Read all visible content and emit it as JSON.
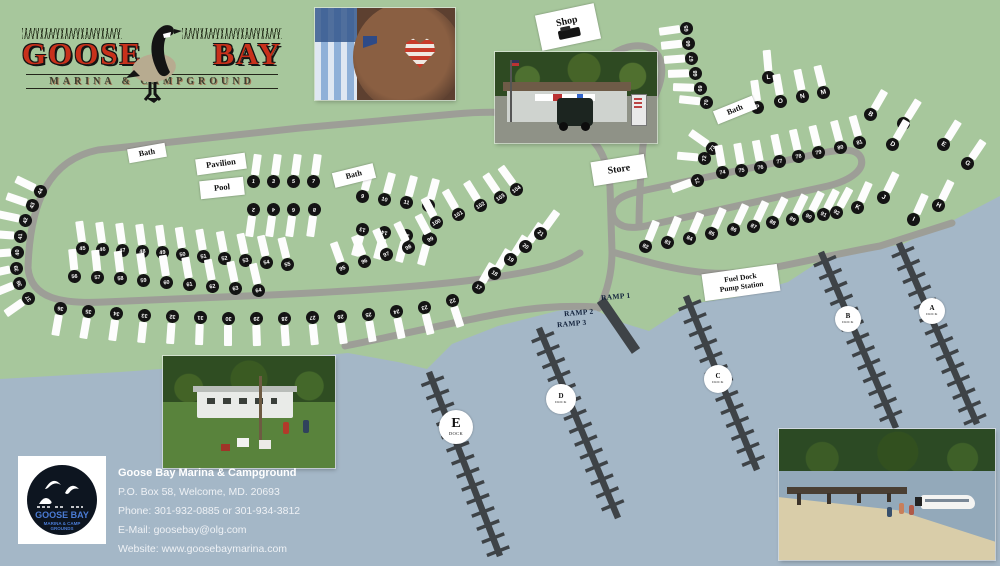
{
  "logo": {
    "word1": "GOOSE",
    "word2": "BAY",
    "subtitle": "MARINA & CAMPGROUND"
  },
  "badge": {
    "line1": "GOOSE BAY",
    "line2": "MARINA & CAMP",
    "line3": "GROUNDS"
  },
  "contact": {
    "title": "Goose Bay Marina & Campground",
    "address": "P.O. Box 58, Welcome, MD. 20693",
    "phone": "Phone: 301-932-0885 or 301-934-3812",
    "email": "E-Mail: goosebay@olg.com",
    "website": "Website: www.goosebaymarina.com"
  },
  "colors": {
    "land": "#a7c79c",
    "water": "#a4b7c7",
    "road": "#9d9e97",
    "dock": "#3e4347",
    "site_circle": "#141414",
    "logo_red": "#c8311b"
  },
  "photos": {
    "top_center": "kid-with-flag-heart-sunglasses-photo",
    "store": "marina-store-photo",
    "bottom_left": "campground-trailer-photo",
    "bottom_right": "beach-and-boat-photo"
  },
  "map": {
    "dock_word": "DOCK",
    "labels": [
      {
        "name": "bath-label-1",
        "lines": [
          "Bath"
        ],
        "x": 128,
        "y": 146,
        "w": 38,
        "h": 14,
        "rot": -10,
        "fs": 8
      },
      {
        "name": "pavilion-label",
        "lines": [
          "Pavilion"
        ],
        "x": 196,
        "y": 156,
        "w": 50,
        "h": 16,
        "rot": -8,
        "fs": 8.5
      },
      {
        "name": "pool-label",
        "lines": [
          "Pool"
        ],
        "x": 200,
        "y": 179,
        "w": 44,
        "h": 18,
        "rot": -6,
        "fs": 8.5
      },
      {
        "name": "bath-label-2",
        "lines": [
          "Bath"
        ],
        "x": 333,
        "y": 168,
        "w": 42,
        "h": 15,
        "rot": -14,
        "fs": 8
      },
      {
        "name": "store-label",
        "lines": [
          "Store"
        ],
        "x": 592,
        "y": 158,
        "w": 54,
        "h": 24,
        "rot": -9,
        "fs": 10
      },
      {
        "name": "shop-label",
        "lines": [
          "Shop"
        ],
        "x": 538,
        "y": 9,
        "w": 60,
        "h": 36,
        "rot": -12,
        "fs": 10,
        "icon": "mower"
      },
      {
        "name": "bath-label-3",
        "lines": [
          "Bath"
        ],
        "x": 714,
        "y": 103,
        "w": 42,
        "h": 14,
        "rot": -22,
        "fs": 8
      },
      {
        "name": "fuel-dock-label",
        "lines": [
          "Fuel Dock",
          "Pump Station"
        ],
        "x": 703,
        "y": 269,
        "w": 76,
        "h": 27,
        "rot": -8,
        "fs": 7.5
      },
      {
        "name": "ramp-1-label",
        "lines": [
          "RAMP 1"
        ],
        "x": 601,
        "y": 293,
        "rot": -5,
        "fs": 7.5,
        "box": false
      },
      {
        "name": "ramp-2-label",
        "lines": [
          "RAMP 2"
        ],
        "x": 564,
        "y": 309,
        "rot": -5,
        "fs": 7.5,
        "box": false
      },
      {
        "name": "ramp-3-label",
        "lines": [
          "RAMP 3"
        ],
        "x": 557,
        "y": 320,
        "rot": -5,
        "fs": 7.5,
        "box": false
      }
    ],
    "docks": [
      {
        "label": "A",
        "x1": 899,
        "y1": 243,
        "x2": 977,
        "y2": 424,
        "cx": 932,
        "cy": 311,
        "r": 13
      },
      {
        "label": "B",
        "x1": 821,
        "y1": 252,
        "x2": 896,
        "y2": 428,
        "cx": 848,
        "cy": 319,
        "r": 13
      },
      {
        "label": "C",
        "x1": 686,
        "y1": 296,
        "x2": 757,
        "y2": 470,
        "cx": 718,
        "cy": 379,
        "r": 14
      },
      {
        "label": "D",
        "x1": 539,
        "y1": 328,
        "x2": 618,
        "y2": 518,
        "cx": 561,
        "cy": 399,
        "r": 15
      },
      {
        "label": "E",
        "x1": 429,
        "y1": 372,
        "x2": 500,
        "y2": 556,
        "cx": 456,
        "cy": 427,
        "r": 17,
        "big": true
      }
    ],
    "ramp_bar": {
      "x1": 601,
      "y1": 300,
      "x2": 636,
      "y2": 351
    },
    "sites": [
      [
        "1",
        253,
        181,
        8
      ],
      [
        "3",
        273,
        181,
        8
      ],
      [
        "5",
        293,
        181,
        8
      ],
      [
        "7",
        313,
        181,
        8
      ],
      [
        "2",
        253,
        209,
        188
      ],
      [
        "4",
        273,
        209,
        188
      ],
      [
        "6",
        293,
        209,
        188
      ],
      [
        "8",
        314,
        209,
        188
      ],
      [
        "9",
        362,
        196,
        15
      ],
      [
        "10",
        384,
        199,
        15
      ],
      [
        "11",
        406,
        202,
        15
      ],
      [
        "12",
        428,
        205,
        15
      ],
      [
        "13",
        362,
        229,
        195
      ],
      [
        "14",
        384,
        232,
        195
      ],
      [
        "15",
        406,
        235,
        195
      ],
      [
        "16",
        428,
        238,
        195
      ],
      [
        "17",
        478,
        287,
        30
      ],
      [
        "18",
        494,
        273,
        30
      ],
      [
        "19",
        510,
        259,
        32
      ],
      [
        "20",
        525,
        246,
        34
      ],
      [
        "21",
        540,
        233,
        36
      ],
      [
        "36",
        60,
        308,
        190
      ],
      [
        "35",
        88,
        311,
        190
      ],
      [
        "34",
        116,
        313,
        188
      ],
      [
        "33",
        144,
        315,
        186
      ],
      [
        "32",
        172,
        316,
        184
      ],
      [
        "31",
        200,
        317,
        182
      ],
      [
        "30",
        228,
        318,
        180
      ],
      [
        "29",
        256,
        318,
        178
      ],
      [
        "28",
        284,
        318,
        176
      ],
      [
        "27",
        312,
        317,
        174
      ],
      [
        "26",
        340,
        316,
        172
      ],
      [
        "25",
        368,
        314,
        170
      ],
      [
        "24",
        396,
        311,
        168
      ],
      [
        "23",
        424,
        307,
        166
      ],
      [
        "22",
        452,
        300,
        162
      ],
      [
        "37",
        28,
        298,
        235
      ],
      [
        "38",
        19,
        283,
        248
      ],
      [
        "39",
        16,
        268,
        258
      ],
      [
        "40",
        17,
        252,
        266
      ],
      [
        "41",
        20,
        236,
        274
      ],
      [
        "42",
        25,
        220,
        282
      ],
      [
        "43",
        32,
        205,
        289
      ],
      [
        "44",
        40,
        191,
        296
      ],
      [
        "45",
        82,
        248,
        352
      ],
      [
        "46",
        102,
        249,
        352
      ],
      [
        "47",
        122,
        250,
        352
      ],
      [
        "48",
        142,
        251,
        352
      ],
      [
        "49",
        162,
        252,
        352
      ],
      [
        "50",
        182,
        254,
        351
      ],
      [
        "51",
        203,
        256,
        350
      ],
      [
        "52",
        224,
        258,
        349
      ],
      [
        "53",
        245,
        260,
        348
      ],
      [
        "54",
        266,
        262,
        347
      ],
      [
        "55",
        287,
        264,
        346
      ],
      [
        "56",
        74,
        276,
        354
      ],
      [
        "57",
        97,
        277,
        354
      ],
      [
        "58",
        120,
        278,
        353
      ],
      [
        "59",
        143,
        280,
        352
      ],
      [
        "60",
        166,
        282,
        351
      ],
      [
        "61",
        189,
        284,
        350
      ],
      [
        "62",
        212,
        286,
        349
      ],
      [
        "63",
        235,
        288,
        348
      ],
      [
        "64",
        258,
        290,
        347
      ],
      [
        "95",
        342,
        268,
        340
      ],
      [
        "96",
        364,
        261,
        338
      ],
      [
        "97",
        386,
        254,
        336
      ],
      [
        "98",
        408,
        247,
        334
      ],
      [
        "99",
        430,
        239,
        332
      ],
      [
        "100",
        436,
        222,
        332
      ],
      [
        "101",
        458,
        214,
        330
      ],
      [
        "102",
        480,
        205,
        328
      ],
      [
        "103",
        500,
        197,
        326
      ],
      [
        "104",
        516,
        189,
        324
      ],
      [
        "65",
        686,
        28,
        262
      ],
      [
        "66",
        688,
        43,
        264
      ],
      [
        "67",
        691,
        58,
        266
      ],
      [
        "68",
        695,
        73,
        268
      ],
      [
        "69",
        700,
        88,
        272
      ],
      [
        "70",
        706,
        102,
        276
      ],
      [
        "L",
        768,
        77,
        355
      ],
      [
        "P",
        757,
        107,
        352
      ],
      [
        "O",
        780,
        101,
        350
      ],
      [
        "N",
        802,
        96,
        348
      ],
      [
        "M",
        823,
        92,
        346
      ],
      [
        "71",
        697,
        180,
        250
      ],
      [
        "72",
        704,
        158,
        275
      ],
      [
        "73",
        712,
        148,
        305
      ],
      [
        "74",
        722,
        172,
        350
      ],
      [
        "75",
        741,
        170,
        350
      ],
      [
        "76",
        760,
        167,
        349
      ],
      [
        "77",
        779,
        161,
        348
      ],
      [
        "78",
        798,
        156,
        347
      ],
      [
        "79",
        818,
        152,
        346
      ],
      [
        "80",
        840,
        147,
        345
      ],
      [
        "81",
        859,
        142,
        344
      ],
      [
        "82",
        645,
        246,
        22
      ],
      [
        "83",
        667,
        242,
        22
      ],
      [
        "84",
        689,
        238,
        23
      ],
      [
        "85",
        711,
        233,
        24
      ],
      [
        "86",
        733,
        229,
        25
      ],
      [
        "87",
        753,
        226,
        25
      ],
      [
        "88",
        772,
        222,
        26
      ],
      [
        "89",
        792,
        219,
        26
      ],
      [
        "90",
        808,
        216,
        27
      ],
      [
        "91",
        823,
        214,
        27
      ],
      [
        "92",
        836,
        212,
        28
      ],
      [
        "B",
        870,
        114,
        30
      ],
      [
        "C",
        903,
        123,
        32
      ],
      [
        "D",
        892,
        144,
        30
      ],
      [
        "E",
        943,
        144,
        32
      ],
      [
        "G",
        967,
        163,
        34
      ],
      [
        "K",
        857,
        207,
        24
      ],
      [
        "J",
        883,
        197,
        26
      ],
      [
        "I",
        913,
        219,
        24
      ],
      [
        "H",
        938,
        205,
        26
      ]
    ]
  }
}
